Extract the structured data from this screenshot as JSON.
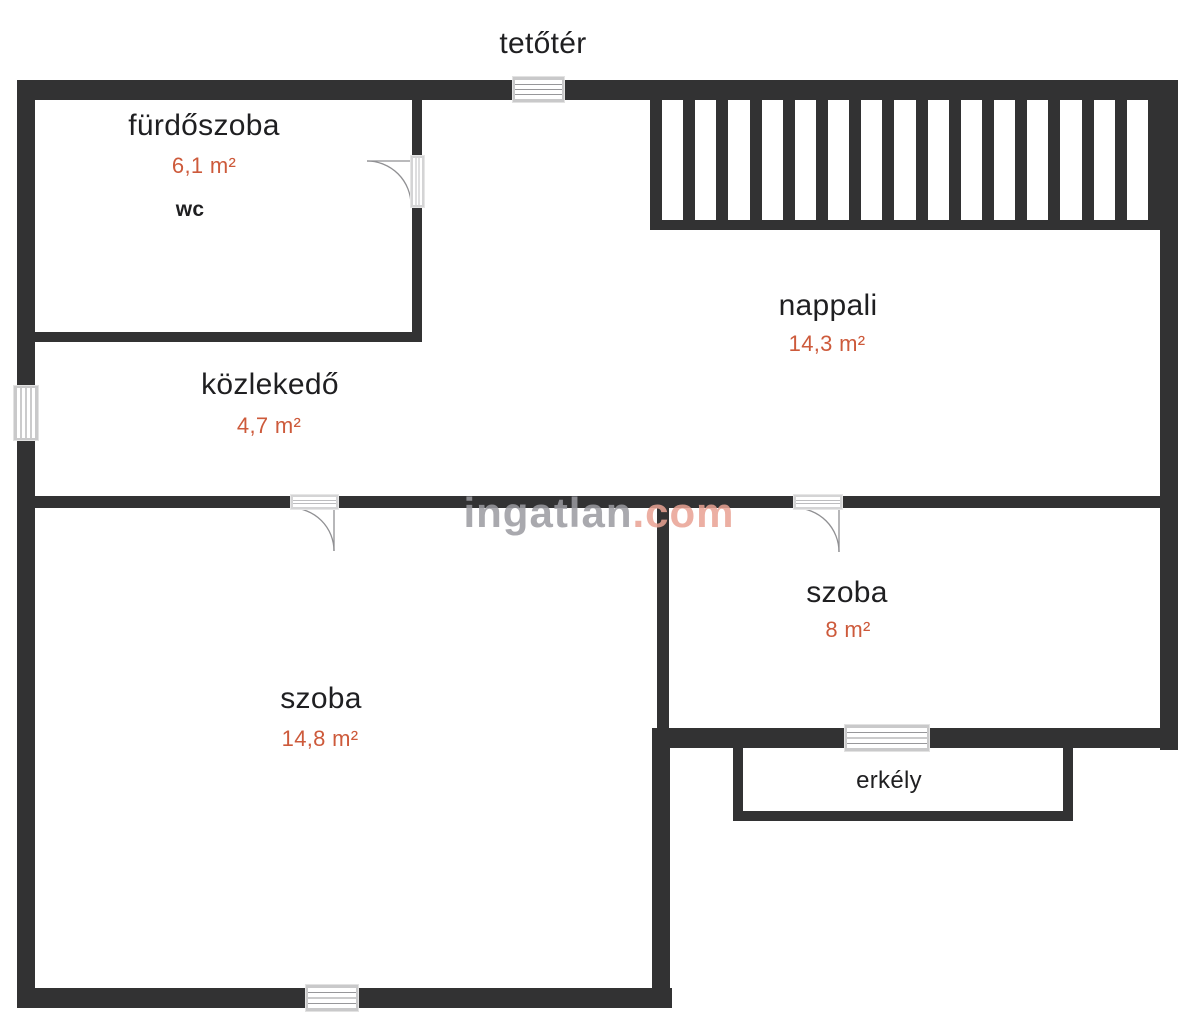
{
  "title": "tetőtér",
  "rooms": [
    {
      "name": "fürdőszoba",
      "area": "6,1 m²",
      "note": "wc"
    },
    {
      "name": "közlekedő",
      "area": "4,7 m²"
    },
    {
      "name": "nappali",
      "area": "14,3 m²"
    },
    {
      "name": "szoba",
      "area": "8 m²"
    },
    {
      "name": "szoba",
      "area": "14,8 m²"
    },
    {
      "name": "erkély"
    }
  ],
  "watermark": {
    "main": "ingatlan",
    "accent": ".com"
  },
  "railing": {
    "balusters": 15
  },
  "colors": {
    "wall": "#323233",
    "room_label": "#1f1f21",
    "area_label": "#cd5a3b",
    "watermark_main": "#9b9ba1",
    "watermark_accent": "#e9a293",
    "window_frame": "#c9c9ca"
  }
}
